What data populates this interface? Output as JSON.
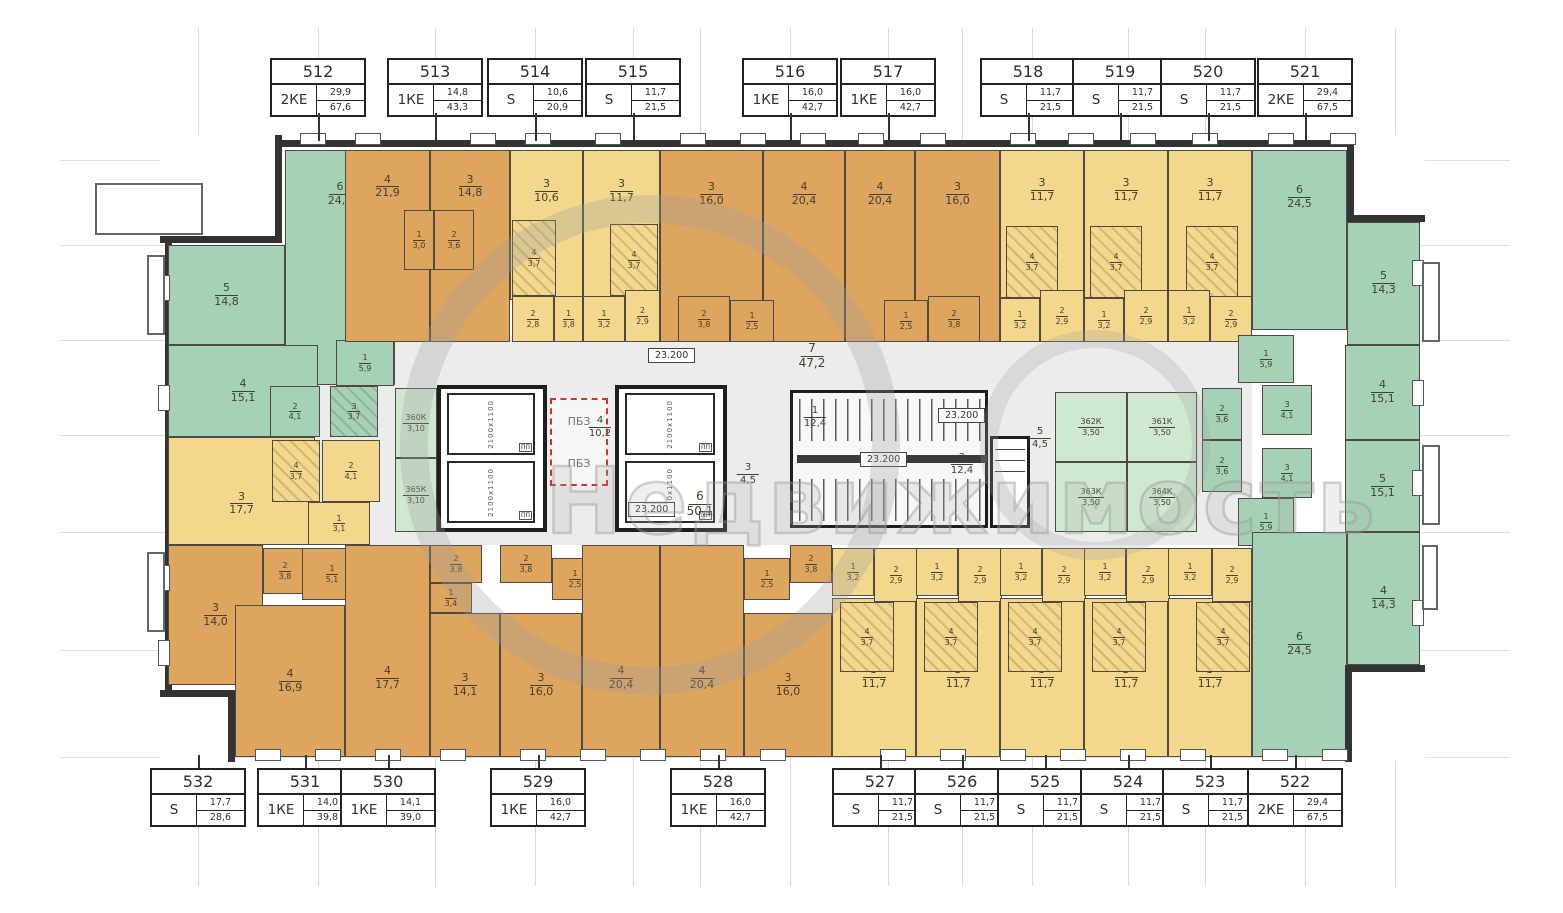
{
  "watermark": {
    "word": "Недвижимость"
  },
  "colors": {
    "green": "#a5d1b7",
    "orange": "#dea55f",
    "yellow": "#f2d78c",
    "storage": "#cfe8d0",
    "wall": "#333333",
    "corridor": "#ececec",
    "label": "#454130",
    "pbz_red": "#cc3333"
  },
  "apartments": {
    "top": [
      {
        "num": "512",
        "type": "2КЕ",
        "a1": "29,9",
        "a2": "67,6",
        "cx": 318
      },
      {
        "num": "513",
        "type": "1КЕ",
        "a1": "14,8",
        "a2": "43,3",
        "cx": 435
      },
      {
        "num": "514",
        "type": "S",
        "a1": "10,6",
        "a2": "20,9",
        "cx": 535
      },
      {
        "num": "515",
        "type": "S",
        "a1": "11,7",
        "a2": "21,5",
        "cx": 633
      },
      {
        "num": "516",
        "type": "1КЕ",
        "a1": "16,0",
        "a2": "42,7",
        "cx": 790
      },
      {
        "num": "517",
        "type": "1КЕ",
        "a1": "16,0",
        "a2": "42,7",
        "cx": 888
      },
      {
        "num": "518",
        "type": "S",
        "a1": "11,7",
        "a2": "21,5",
        "cx": 1028
      },
      {
        "num": "519",
        "type": "S",
        "a1": "11,7",
        "a2": "21,5",
        "cx": 1120
      },
      {
        "num": "520",
        "type": "S",
        "a1": "11,7",
        "a2": "21,5",
        "cx": 1208
      },
      {
        "num": "521",
        "type": "2КЕ",
        "a1": "29,4",
        "a2": "67,5",
        "cx": 1305
      }
    ],
    "bottom": [
      {
        "num": "532",
        "type": "S",
        "a1": "17,7",
        "a2": "28,6",
        "cx": 198
      },
      {
        "num": "531",
        "type": "1КЕ",
        "a1": "14,0",
        "a2": "39,8",
        "cx": 305
      },
      {
        "num": "530",
        "type": "1КЕ",
        "a1": "14,1",
        "a2": "39,0",
        "cx": 388
      },
      {
        "num": "529",
        "type": "1КЕ",
        "a1": "16,0",
        "a2": "42,7",
        "cx": 538
      },
      {
        "num": "528",
        "type": "1КЕ",
        "a1": "16,0",
        "a2": "42,7",
        "cx": 718
      },
      {
        "num": "527",
        "type": "S",
        "a1": "11,7",
        "a2": "21,5",
        "cx": 880
      },
      {
        "num": "526",
        "type": "S",
        "a1": "11,7",
        "a2": "21,5",
        "cx": 962
      },
      {
        "num": "525",
        "type": "S",
        "a1": "11,7",
        "a2": "21,5",
        "cx": 1045
      },
      {
        "num": "524",
        "type": "S",
        "a1": "11,7",
        "a2": "21,5",
        "cx": 1128
      },
      {
        "num": "523",
        "type": "S",
        "a1": "11,7",
        "a2": "21,5",
        "cx": 1210
      },
      {
        "num": "522",
        "type": "2КЕ",
        "a1": "29,4",
        "a2": "67,5",
        "cx": 1295
      }
    ]
  },
  "rooms": [
    {
      "n": "6",
      "a": "24,0",
      "c": "g",
      "x": 285,
      "y": 150,
      "w": 110,
      "h": 235,
      "ly": 18
    },
    {
      "n": "5",
      "a": "14,8",
      "c": "g",
      "x": 168,
      "y": 245,
      "w": 117,
      "h": 100
    },
    {
      "n": "4",
      "a": "15,1",
      "c": "g",
      "x": 168,
      "y": 345,
      "w": 150,
      "h": 92
    },
    {
      "n": "1",
      "a": "5,9",
      "c": "g",
      "x": 336,
      "y": 340,
      "w": 58,
      "h": 46,
      "s": 1
    },
    {
      "n": "2",
      "a": "4,1",
      "c": "g",
      "x": 270,
      "y": 386,
      "w": 50,
      "h": 51,
      "s": 1
    },
    {
      "n": "3",
      "a": "3,7",
      "c": "g",
      "x": 330,
      "y": 386,
      "w": 48,
      "h": 51,
      "s": 1,
      "k": 1
    },
    {
      "n": "4",
      "a": "21,9",
      "c": "o",
      "x": 345,
      "y": 150,
      "w": 85,
      "h": 192,
      "ly": 18
    },
    {
      "n": "3",
      "a": "14,8",
      "c": "o",
      "x": 430,
      "y": 150,
      "w": 80,
      "h": 192,
      "ly": 18
    },
    {
      "n": "1",
      "a": "3,0",
      "c": "o",
      "x": 404,
      "y": 210,
      "w": 30,
      "h": 60,
      "s": 1
    },
    {
      "n": "2",
      "a": "3,6",
      "c": "o",
      "x": 434,
      "y": 210,
      "w": 40,
      "h": 60,
      "s": 1
    },
    {
      "n": "3",
      "a": "10,6",
      "c": "y",
      "x": 510,
      "y": 150,
      "w": 73,
      "h": 150,
      "ly": 26
    },
    {
      "n": "4",
      "a": "3,7",
      "c": "y",
      "x": 512,
      "y": 220,
      "w": 44,
      "h": 76,
      "s": 1,
      "k": 1
    },
    {
      "n": "2",
      "a": "2,8",
      "c": "y",
      "x": 512,
      "y": 296,
      "w": 42,
      "h": 46,
      "s": 1
    },
    {
      "n": "1",
      "a": "3,8",
      "c": "y",
      "x": 554,
      "y": 296,
      "w": 29,
      "h": 46,
      "s": 1
    },
    {
      "n": "3",
      "a": "11,7",
      "c": "y",
      "x": 583,
      "y": 150,
      "w": 77,
      "h": 150,
      "ly": 26
    },
    {
      "n": "4",
      "a": "3,7",
      "c": "y",
      "x": 610,
      "y": 224,
      "w": 48,
      "h": 72,
      "s": 1,
      "k": 1
    },
    {
      "n": "1",
      "a": "3,2",
      "c": "y",
      "x": 583,
      "y": 296,
      "w": 42,
      "h": 46,
      "s": 1
    },
    {
      "n": "2",
      "a": "2,9",
      "c": "y",
      "x": 625,
      "y": 290,
      "w": 35,
      "h": 52,
      "s": 1
    },
    {
      "n": "3",
      "a": "16,0",
      "c": "o",
      "x": 660,
      "y": 150,
      "w": 103,
      "h": 192,
      "ly": 22
    },
    {
      "n": "4",
      "a": "20,4",
      "c": "o",
      "x": 763,
      "y": 150,
      "w": 82,
      "h": 192,
      "ly": 22
    },
    {
      "n": "2",
      "a": "3,8",
      "c": "o",
      "x": 678,
      "y": 296,
      "w": 52,
      "h": 46,
      "s": 1
    },
    {
      "n": "1",
      "a": "2,5",
      "c": "o",
      "x": 730,
      "y": 300,
      "w": 44,
      "h": 42,
      "s": 1
    },
    {
      "n": "4",
      "a": "20,4",
      "c": "o",
      "x": 845,
      "y": 150,
      "w": 70,
      "h": 192,
      "ly": 22
    },
    {
      "n": "3",
      "a": "16,0",
      "c": "o",
      "x": 915,
      "y": 150,
      "w": 85,
      "h": 192,
      "ly": 22
    },
    {
      "n": "1",
      "a": "2,5",
      "c": "o",
      "x": 884,
      "y": 300,
      "w": 44,
      "h": 42,
      "s": 1
    },
    {
      "n": "2",
      "a": "3,8",
      "c": "o",
      "x": 928,
      "y": 296,
      "w": 52,
      "h": 46,
      "s": 1
    },
    {
      "n": "3",
      "a": "11,7",
      "c": "y",
      "x": 1000,
      "y": 150,
      "w": 84,
      "h": 148,
      "ly": 26
    },
    {
      "n": "4",
      "a": "3,7",
      "c": "y",
      "x": 1006,
      "y": 226,
      "w": 52,
      "h": 72,
      "s": 1,
      "k": 1
    },
    {
      "n": "1",
      "a": "3,2",
      "c": "y",
      "x": 1000,
      "y": 298,
      "w": 40,
      "h": 44,
      "s": 1
    },
    {
      "n": "2",
      "a": "2,9",
      "c": "y",
      "x": 1040,
      "y": 290,
      "w": 44,
      "h": 52,
      "s": 1
    },
    {
      "n": "3",
      "a": "11,7",
      "c": "y",
      "x": 1084,
      "y": 150,
      "w": 84,
      "h": 148,
      "ly": 26
    },
    {
      "n": "4",
      "a": "3,7",
      "c": "y",
      "x": 1090,
      "y": 226,
      "w": 52,
      "h": 72,
      "s": 1,
      "k": 1
    },
    {
      "n": "1",
      "a": "3,2",
      "c": "y",
      "x": 1084,
      "y": 298,
      "w": 40,
      "h": 44,
      "s": 1
    },
    {
      "n": "2",
      "a": "2,9",
      "c": "y",
      "x": 1124,
      "y": 290,
      "w": 44,
      "h": 52,
      "s": 1
    },
    {
      "n": "3",
      "a": "11,7",
      "c": "y",
      "x": 1168,
      "y": 150,
      "w": 84,
      "h": 148,
      "ly": 26
    },
    {
      "n": "4",
      "a": "3,7",
      "c": "y",
      "x": 1186,
      "y": 226,
      "w": 52,
      "h": 72,
      "s": 1,
      "k": 1
    },
    {
      "n": "1",
      "a": "3,2",
      "c": "y",
      "x": 1168,
      "y": 290,
      "w": 42,
      "h": 52,
      "s": 1
    },
    {
      "n": "2",
      "a": "2,9",
      "c": "y",
      "x": 1210,
      "y": 296,
      "w": 42,
      "h": 46,
      "s": 1
    },
    {
      "n": "6",
      "a": "24,5",
      "c": "g",
      "x": 1252,
      "y": 150,
      "w": 95,
      "h": 180,
      "ly": 25
    },
    {
      "n": "5",
      "a": "14,3",
      "c": "g",
      "x": 1347,
      "y": 222,
      "w": 73,
      "h": 123
    },
    {
      "n": "1",
      "a": "5,9",
      "c": "g",
      "x": 1238,
      "y": 335,
      "w": 56,
      "h": 48,
      "s": 1
    },
    {
      "n": "3",
      "a": "4,1",
      "c": "g",
      "x": 1262,
      "y": 385,
      "w": 50,
      "h": 50,
      "s": 1
    },
    {
      "n": "2",
      "a": "3,6",
      "c": "g",
      "x": 1202,
      "y": 388,
      "w": 40,
      "h": 52,
      "s": 1
    },
    {
      "n": "4",
      "a": "15,1",
      "c": "g",
      "x": 1345,
      "y": 345,
      "w": 75,
      "h": 95
    },
    {
      "n": "5",
      "a": "15,1",
      "c": "g",
      "x": 1345,
      "y": 440,
      "w": 75,
      "h": 92
    },
    {
      "n": "2",
      "a": "3,6",
      "c": "g",
      "x": 1202,
      "y": 440,
      "w": 40,
      "h": 52,
      "s": 1
    },
    {
      "n": "3",
      "a": "4,1",
      "c": "g",
      "x": 1262,
      "y": 448,
      "w": 50,
      "h": 50,
      "s": 1
    },
    {
      "n": "1",
      "a": "5,9",
      "c": "g",
      "x": 1238,
      "y": 498,
      "w": 56,
      "h": 48,
      "s": 1
    },
    {
      "n": "6",
      "a": "24,5",
      "c": "g",
      "x": 1252,
      "y": 532,
      "w": 95,
      "h": 225
    },
    {
      "n": "4",
      "a": "14,3",
      "c": "g",
      "x": 1347,
      "y": 532,
      "w": 73,
      "h": 133
    },
    {
      "n": "3",
      "a": "17,7",
      "c": "y",
      "x": 168,
      "y": 437,
      "w": 147,
      "h": 108,
      "ly": 60
    },
    {
      "n": "4",
      "a": "3,7",
      "c": "y",
      "x": 272,
      "y": 440,
      "w": 48,
      "h": 62,
      "s": 1,
      "k": 1
    },
    {
      "n": "2",
      "a": "4,1",
      "c": "y",
      "x": 322,
      "y": 440,
      "w": 58,
      "h": 62,
      "s": 1
    },
    {
      "n": "1",
      "a": "3,1",
      "c": "y",
      "x": 308,
      "y": 502,
      "w": 62,
      "h": 43,
      "s": 1
    },
    {
      "n": "3",
      "a": "14,0",
      "c": "o",
      "x": 168,
      "y": 545,
      "w": 95,
      "h": 140
    },
    {
      "n": "2",
      "a": "3,8",
      "c": "o",
      "x": 263,
      "y": 548,
      "w": 44,
      "h": 46,
      "s": 1
    },
    {
      "n": "1",
      "a": "5,1",
      "c": "o",
      "x": 302,
      "y": 548,
      "w": 60,
      "h": 52,
      "s": 1
    },
    {
      "n": "4",
      "a": "16,9",
      "c": "o",
      "x": 235,
      "y": 605,
      "w": 110,
      "h": 152
    },
    {
      "n": "4",
      "a": "17,7",
      "c": "o",
      "x": 345,
      "y": 545,
      "w": 85,
      "h": 212,
      "ly": 62
    },
    {
      "n": "3",
      "a": "14,1",
      "c": "o",
      "x": 430,
      "y": 613,
      "w": 70,
      "h": 144
    },
    {
      "n": "2",
      "a": "3,8",
      "c": "o",
      "x": 430,
      "y": 545,
      "w": 52,
      "h": 38,
      "s": 1
    },
    {
      "n": "1",
      "a": "3,4",
      "c": "o",
      "x": 430,
      "y": 583,
      "w": 42,
      "h": 30,
      "s": 1
    },
    {
      "n": "2",
      "a": "3,8",
      "c": "o",
      "x": 500,
      "y": 545,
      "w": 52,
      "h": 38,
      "s": 1
    },
    {
      "n": "1",
      "a": "2,5",
      "c": "o",
      "x": 552,
      "y": 558,
      "w": 46,
      "h": 42,
      "s": 1
    },
    {
      "n": "3",
      "a": "16,0",
      "c": "o",
      "x": 500,
      "y": 613,
      "w": 82,
      "h": 144
    },
    {
      "n": "4",
      "a": "20,4",
      "c": "o",
      "x": 582,
      "y": 545,
      "w": 78,
      "h": 212,
      "ly": 62
    },
    {
      "n": "4",
      "a": "20,4",
      "c": "o",
      "x": 660,
      "y": 545,
      "w": 84,
      "h": 212,
      "ly": 62
    },
    {
      "n": "3",
      "a": "16,0",
      "c": "o",
      "x": 744,
      "y": 613,
      "w": 88,
      "h": 144
    },
    {
      "n": "1",
      "a": "2,5",
      "c": "o",
      "x": 744,
      "y": 558,
      "w": 46,
      "h": 42,
      "s": 1
    },
    {
      "n": "2",
      "a": "3,8",
      "c": "o",
      "x": 790,
      "y": 545,
      "w": 42,
      "h": 38,
      "s": 1
    },
    {
      "n": "3",
      "a": "11,7",
      "c": "y",
      "x": 832,
      "y": 598,
      "w": 84,
      "h": 159
    },
    {
      "n": "4",
      "a": "3,7",
      "c": "y",
      "x": 840,
      "y": 602,
      "w": 54,
      "h": 70,
      "s": 1,
      "k": 1
    },
    {
      "n": "1",
      "a": "3,2",
      "c": "y",
      "x": 832,
      "y": 548,
      "w": 42,
      "h": 48,
      "s": 1
    },
    {
      "n": "2",
      "a": "2,9",
      "c": "y",
      "x": 874,
      "y": 548,
      "w": 44,
      "h": 54,
      "s": 1
    },
    {
      "n": "3",
      "a": "11,7",
      "c": "y",
      "x": 916,
      "y": 598,
      "w": 84,
      "h": 159
    },
    {
      "n": "4",
      "a": "3,7",
      "c": "y",
      "x": 924,
      "y": 602,
      "w": 54,
      "h": 70,
      "s": 1,
      "k": 1
    },
    {
      "n": "1",
      "a": "3,2",
      "c": "y",
      "x": 916,
      "y": 548,
      "w": 42,
      "h": 48,
      "s": 1
    },
    {
      "n": "2",
      "a": "2,9",
      "c": "y",
      "x": 958,
      "y": 548,
      "w": 44,
      "h": 54,
      "s": 1
    },
    {
      "n": "3",
      "a": "11,7",
      "c": "y",
      "x": 1000,
      "y": 598,
      "w": 84,
      "h": 159
    },
    {
      "n": "4",
      "a": "3,7",
      "c": "y",
      "x": 1008,
      "y": 602,
      "w": 54,
      "h": 70,
      "s": 1,
      "k": 1
    },
    {
      "n": "1",
      "a": "3,2",
      "c": "y",
      "x": 1000,
      "y": 548,
      "w": 42,
      "h": 48,
      "s": 1
    },
    {
      "n": "2",
      "a": "2,9",
      "c": "y",
      "x": 1042,
      "y": 548,
      "w": 44,
      "h": 54,
      "s": 1
    },
    {
      "n": "3",
      "a": "11,7",
      "c": "y",
      "x": 1084,
      "y": 598,
      "w": 84,
      "h": 159
    },
    {
      "n": "4",
      "a": "3,7",
      "c": "y",
      "x": 1092,
      "y": 602,
      "w": 54,
      "h": 70,
      "s": 1,
      "k": 1
    },
    {
      "n": "1",
      "a": "3,2",
      "c": "y",
      "x": 1084,
      "y": 548,
      "w": 42,
      "h": 48,
      "s": 1
    },
    {
      "n": "2",
      "a": "2,9",
      "c": "y",
      "x": 1126,
      "y": 548,
      "w": 44,
      "h": 54,
      "s": 1
    },
    {
      "n": "3",
      "a": "11,7",
      "c": "y",
      "x": 1168,
      "y": 598,
      "w": 84,
      "h": 159
    },
    {
      "n": "4",
      "a": "3,7",
      "c": "y",
      "x": 1196,
      "y": 602,
      "w": 54,
      "h": 70,
      "s": 1,
      "k": 1
    },
    {
      "n": "1",
      "a": "3,2",
      "c": "y",
      "x": 1168,
      "y": 548,
      "w": 44,
      "h": 48,
      "s": 1
    },
    {
      "n": "2",
      "a": "2,9",
      "c": "y",
      "x": 1212,
      "y": 548,
      "w": 40,
      "h": 54,
      "s": 1
    }
  ],
  "storage_rooms": [
    {
      "n": "360К",
      "a": "3,10",
      "x": 395,
      "y": 388,
      "w": 42,
      "h": 70
    },
    {
      "n": "365К",
      "a": "3,10",
      "x": 395,
      "y": 458,
      "w": 42,
      "h": 74
    },
    {
      "n": "362К",
      "a": "3,50",
      "x": 1055,
      "y": 392,
      "w": 72,
      "h": 70
    },
    {
      "n": "361К",
      "a": "3,50",
      "x": 1127,
      "y": 392,
      "w": 70,
      "h": 70
    },
    {
      "n": "363К",
      "a": "3,50",
      "x": 1055,
      "y": 462,
      "w": 72,
      "h": 70
    },
    {
      "n": "364К",
      "a": "3,50",
      "x": 1127,
      "y": 462,
      "w": 70,
      "h": 70
    }
  ],
  "elevators": {
    "shaft_size_label": "2100х1100",
    "fire_label": "ПП",
    "cores": [
      {
        "x": 437,
        "y": 385,
        "w": 110,
        "h": 147
      },
      {
        "x": 615,
        "y": 385,
        "w": 112,
        "h": 147
      }
    ]
  },
  "stairs": {
    "x": 790,
    "y": 390,
    "w": 198,
    "h": 138
  },
  "duct": {
    "x": 990,
    "y": 436,
    "w": 40,
    "h": 92
  },
  "pbz": {
    "text": "ПБЗ",
    "x": 550,
    "y": 398,
    "w": 58,
    "h": 88
  },
  "level_mark": "23.200",
  "level_positions": [
    {
      "x": 648,
      "y": 348
    },
    {
      "x": 628,
      "y": 502
    },
    {
      "x": 938,
      "y": 408
    },
    {
      "x": 860,
      "y": 452
    }
  ],
  "corridor_labels": [
    {
      "n": "7",
      "a": "47,2",
      "x": 812,
      "y": 342,
      "fs": 12
    },
    {
      "n": "4",
      "a": "10,2",
      "x": 600,
      "y": 415,
      "fs": 10
    },
    {
      "n": "3",
      "a": "4,5",
      "x": 748,
      "y": 462,
      "fs": 10
    },
    {
      "n": "1",
      "a": "12,4",
      "x": 815,
      "y": 405,
      "fs": 10
    },
    {
      "n": "2",
      "a": "12,4",
      "x": 962,
      "y": 452,
      "fs": 10
    },
    {
      "n": "5",
      "a": "4,5",
      "x": 1040,
      "y": 426,
      "fs": 10
    },
    {
      "n": "6",
      "a": "50,1",
      "x": 700,
      "y": 490,
      "fs": 12
    }
  ],
  "windows": {
    "top": [
      300,
      355,
      470,
      525,
      595,
      680,
      740,
      800,
      858,
      920,
      1010,
      1068,
      1130,
      1192,
      1268,
      1330
    ],
    "bottom": [
      255,
      315,
      375,
      440,
      520,
      580,
      640,
      700,
      760,
      880,
      940,
      1000,
      1060,
      1120,
      1180,
      1262,
      1322
    ],
    "left": [
      275,
      385,
      565,
      640
    ],
    "right": [
      260,
      380,
      470,
      600
    ]
  },
  "balconies": [
    {
      "x": 95,
      "y": 183,
      "w": 108,
      "h": 52
    },
    {
      "x": 147,
      "y": 255,
      "w": 18,
      "h": 80
    },
    {
      "x": 147,
      "y": 552,
      "w": 18,
      "h": 80
    },
    {
      "x": 1422,
      "y": 262,
      "w": 18,
      "h": 80
    },
    {
      "x": 1422,
      "y": 445,
      "w": 18,
      "h": 80
    },
    {
      "x": 1422,
      "y": 545,
      "w": 16,
      "h": 65
    }
  ],
  "grid": {
    "vx": [
      198,
      318,
      435,
      535,
      633,
      700,
      790,
      888,
      962,
      1032,
      1128,
      1205,
      1305,
      1395
    ],
    "hy": [
      160,
      245,
      340,
      435,
      532,
      650,
      757
    ]
  }
}
